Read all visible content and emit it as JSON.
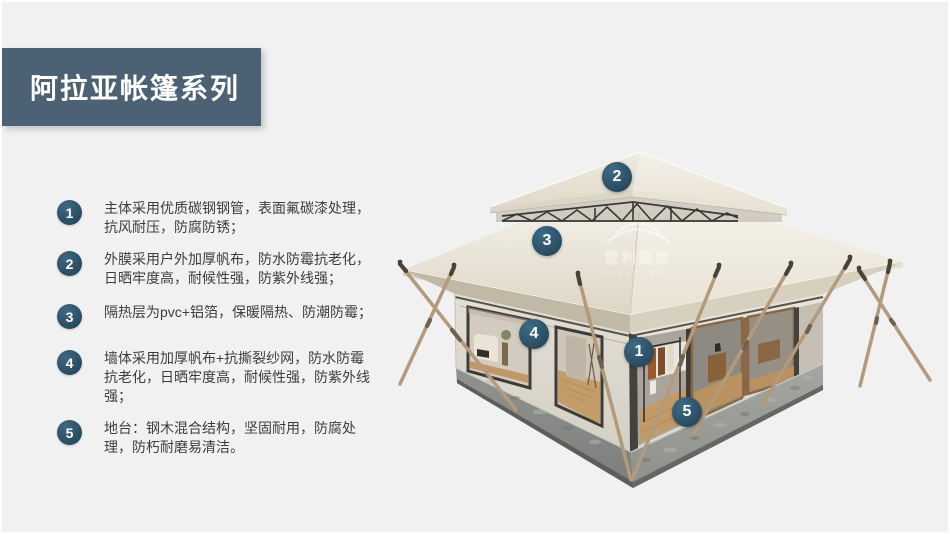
{
  "banner": {
    "title": "阿拉亚帐篷系列",
    "bg_color": "#4c6174"
  },
  "features": [
    {
      "num": "1",
      "text": "主体采用优质碳钢钢管，表面氟碳漆处理，抗风耐压，防腐防锈；"
    },
    {
      "num": "2",
      "text": "外膜采用户外加厚帆布，防水防霉抗老化，日晒牢度高，耐候性强，防紫外线强；"
    },
    {
      "num": "3",
      "text": "隔热层为pvc+铝箔，保暖隔热、防潮防霉；"
    },
    {
      "num": "4",
      "text": "墙体采用加厚帆布+抗撕裂纱网，防水防霉抗老化，日晒牢度高，耐候性强，防紫外线强；"
    },
    {
      "num": "5",
      "text": "地台：钢木混合结构，坚固耐用，防腐处理，防朽耐磨易清洁。"
    }
  ],
  "callouts": [
    {
      "num": "1"
    },
    {
      "num": "2"
    },
    {
      "num": "3"
    },
    {
      "num": "4"
    },
    {
      "num": "5"
    }
  ],
  "watermark": {
    "cn": "雪利篷房",
    "en": "XUELI TENT"
  },
  "colors": {
    "background": "#f1f1f2",
    "banner": "#4c6174",
    "badge": "#2d5066",
    "roof_canvas": "#e9e4d8",
    "wall_canvas": "#dcd8cd",
    "base_concrete": "#96998f",
    "pole_wood": "#b49a7c"
  }
}
